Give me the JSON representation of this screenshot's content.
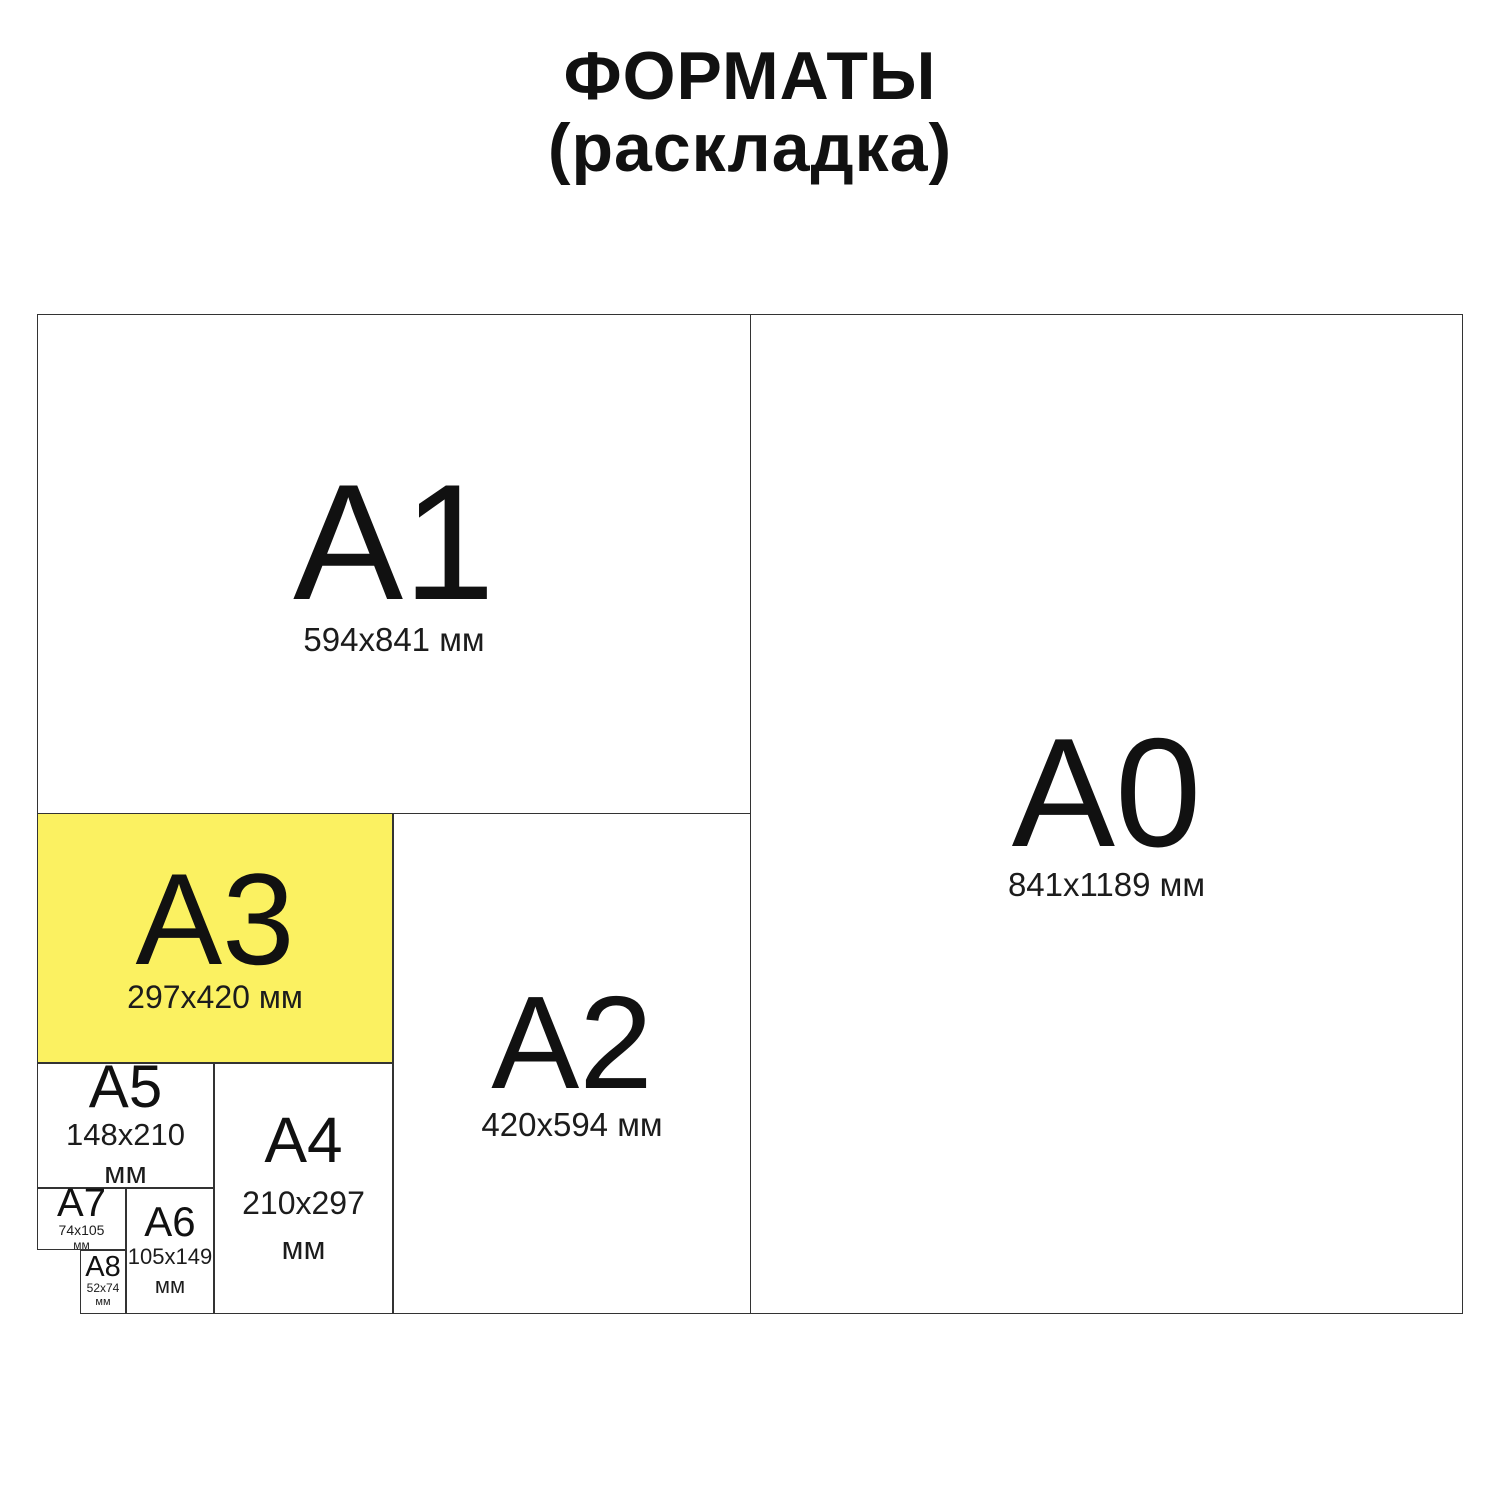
{
  "title": {
    "line1": "ФОРМАТЫ",
    "line2": "(раскладка)"
  },
  "colors": {
    "highlight_yellow": "#FBF161",
    "line": "#333333",
    "text": "#111111",
    "background": "#FFFFFF"
  },
  "highlighted_format": "A3",
  "formats": {
    "a0": {
      "label": "A0",
      "dims": "841x1189 мм"
    },
    "a1": {
      "label": "A1",
      "dims": "594x841 мм"
    },
    "a2": {
      "label": "A2",
      "dims": "420x594 мм"
    },
    "a3": {
      "label": "A3",
      "dims": "297x420 мм"
    },
    "a4": {
      "label": "A4",
      "dims": "210x297",
      "unit": "мм"
    },
    "a5": {
      "label": "A5",
      "dims": "148x210",
      "unit": "мм"
    },
    "a6": {
      "label": "A6",
      "dims": "105x149",
      "unit": "мм"
    },
    "a7": {
      "label": "A7",
      "dims": "74x105",
      "unit": "мм"
    },
    "a8": {
      "label": "A8",
      "dims": "52x74",
      "unit": "мм"
    }
  }
}
